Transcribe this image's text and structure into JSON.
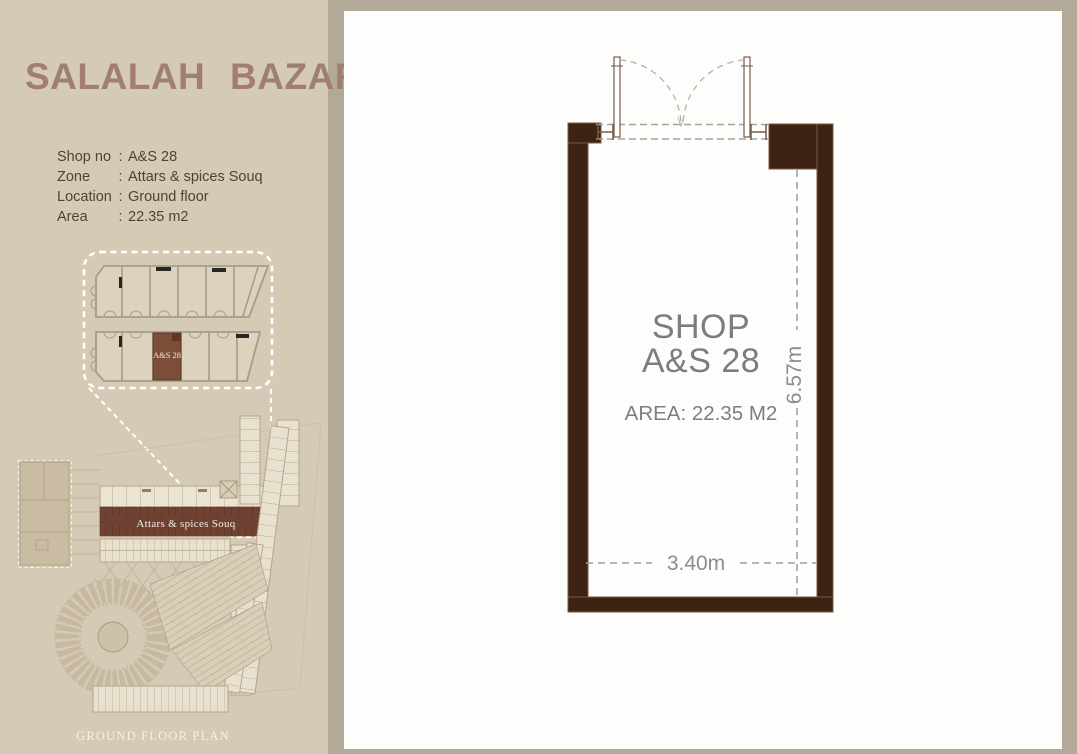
{
  "colors": {
    "frame": "#b2a999",
    "sidebar_bg": "#d5cab5",
    "panel_bg": "#fdfdfc",
    "title": "#a17f70",
    "info_text": "#4e4336",
    "wall": "#3e2315",
    "wall_outline": "#7a5a45",
    "zone_strip": "#6f4233",
    "inset_highlight": "#7c4e3a",
    "plan_line": "#b3a68b",
    "plan_fill": "#e9e1cf",
    "dim_line": "#9c9c9c",
    "shop_text": "#7d7d7d"
  },
  "sidebar": {
    "title": "SALALAH BAZAR",
    "info": {
      "separator": ":",
      "rows": [
        {
          "label": "Shop no",
          "value": "A&S 28"
        },
        {
          "label": "Zone",
          "value": "Attars & spices Souq"
        },
        {
          "label": "Location",
          "value": "Ground floor"
        },
        {
          "label": "Area",
          "value": "22.35 m2"
        }
      ]
    },
    "inset": {
      "highlight_label": "A&S 28"
    },
    "plan": {
      "zone_label": "Attars & spices Souq",
      "caption": "GROUND FLOOR PLAN"
    }
  },
  "shop_plan": {
    "title_line1": "SHOP",
    "title_line2": "A&S 28",
    "area_label": "AREA: 22.35 M2",
    "width_dim": "3.40m",
    "depth_dim": "6.57m"
  }
}
